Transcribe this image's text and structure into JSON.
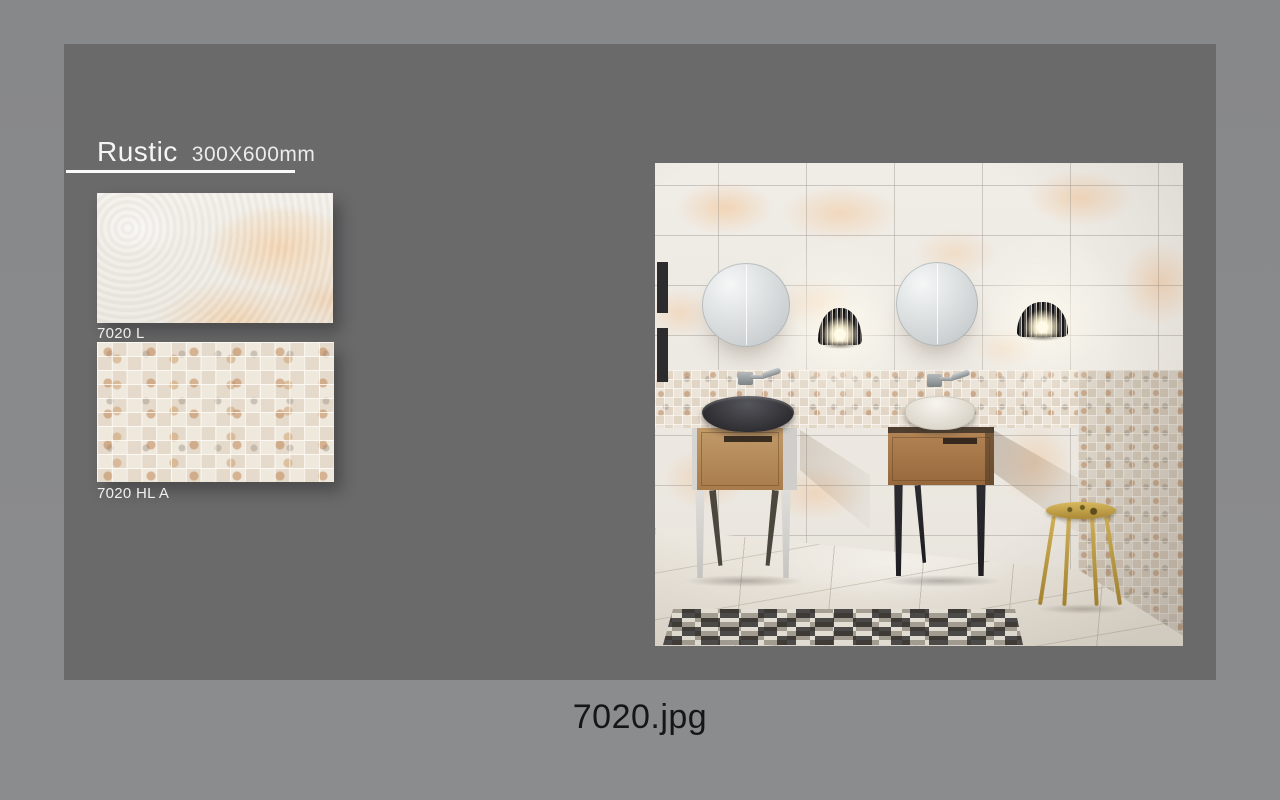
{
  "catalog": {
    "title": "Rustic",
    "size_label": "300X600mm",
    "samples": [
      {
        "code": "7020 L"
      },
      {
        "code": "7020 HL A"
      }
    ]
  },
  "caption": {
    "filename": "7020.jpg"
  },
  "colors": {
    "outer_background": "#8a8b8d",
    "page_background": "#6a6a6b",
    "title_text": "#f6f5f4",
    "label_text": "#f0efee",
    "caption_text": "#161616",
    "tile_peach": "#f3d0a8",
    "tile_cream": "#ece8e0",
    "wood": "#b08152",
    "stool_gold": "#c9a84c"
  }
}
